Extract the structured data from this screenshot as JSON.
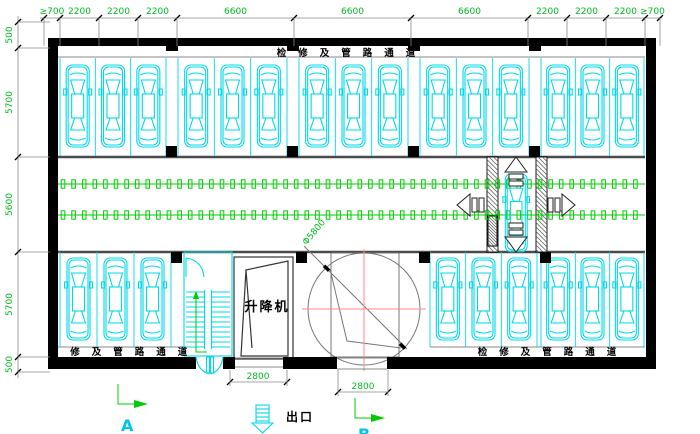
{
  "drawing": {
    "labels": {
      "corridor_top": "检修及管路通道",
      "corridor_bottom_left": "检修及管路通道",
      "corridor_bottom_right": "检修及管路通道",
      "lift": "升降机",
      "exit": "出口",
      "axis_a": "A",
      "axis_b": "B",
      "turntable_diameter": "Φ5800"
    },
    "dimensions": {
      "top": [
        "≥700",
        "2200",
        "2200",
        "2200",
        "6600",
        "6600",
        "6600",
        "2200",
        "2200",
        "2200",
        "≥700"
      ],
      "left": [
        "500",
        "5700",
        "5600",
        "5700",
        "500"
      ],
      "bottom": [
        "2800",
        "2800"
      ]
    },
    "parking": {
      "top_row_car_groups": [
        3,
        3,
        3,
        3,
        3
      ],
      "bottom_left_car_groups": [
        3
      ],
      "bottom_right_car_groups": [
        3,
        3
      ],
      "shuttle_cars": 1
    },
    "colors": {
      "car": "#00d9e8",
      "chain": "#00cc00",
      "dimension_text": "#00bb22",
      "centerline": "#ff8888",
      "wall": "#000000",
      "thin_line": "#8a8a8a",
      "label_text": "#000000",
      "cyan_label": "#00c4ee"
    }
  }
}
